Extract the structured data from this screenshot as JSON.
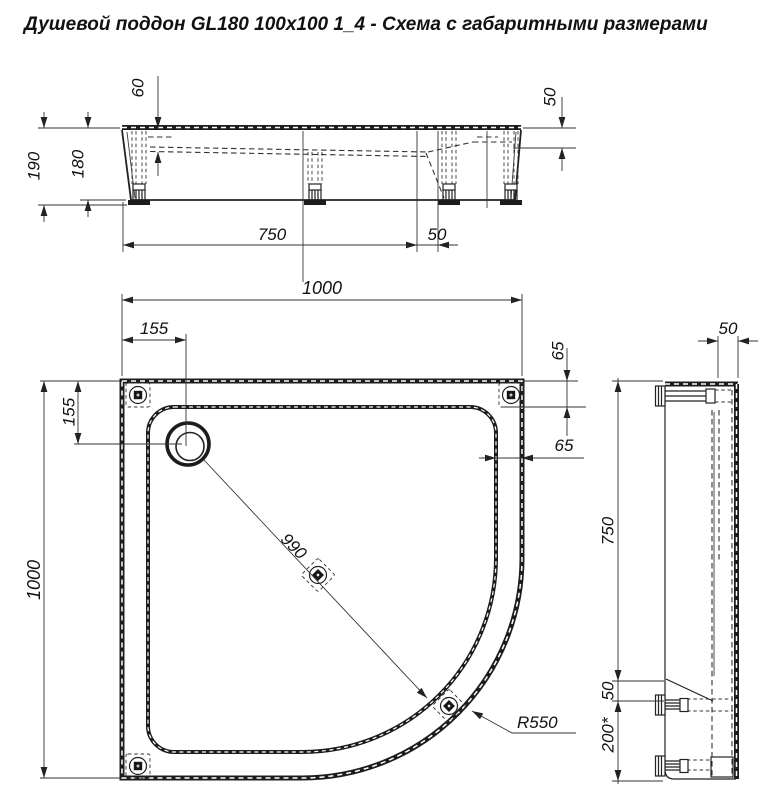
{
  "title": "Душевой поддон GL180  100х100 1_4 - Схема с габаритными размерами",
  "front_view": {
    "dim_60": "60",
    "dim_50_top_right": "50",
    "dim_190": "190",
    "dim_180": "180",
    "dim_750": "750",
    "dim_50_bottom": "50"
  },
  "plan_view": {
    "dim_1000_top": "1000",
    "dim_155_horizontal": "155",
    "dim_155_vertical": "155",
    "dim_65_vertical": "65",
    "dim_65_horizontal": "65",
    "dim_1000_left": "1000",
    "dim_990_diagonal": "990",
    "radius_label": "R550"
  },
  "side_view": {
    "dim_50_top": "50",
    "dim_750": "750",
    "dim_50_middle": "50",
    "dim_200_starred": "200*"
  },
  "colors": {
    "line": "#1c1c1c",
    "background": "#ffffff"
  }
}
